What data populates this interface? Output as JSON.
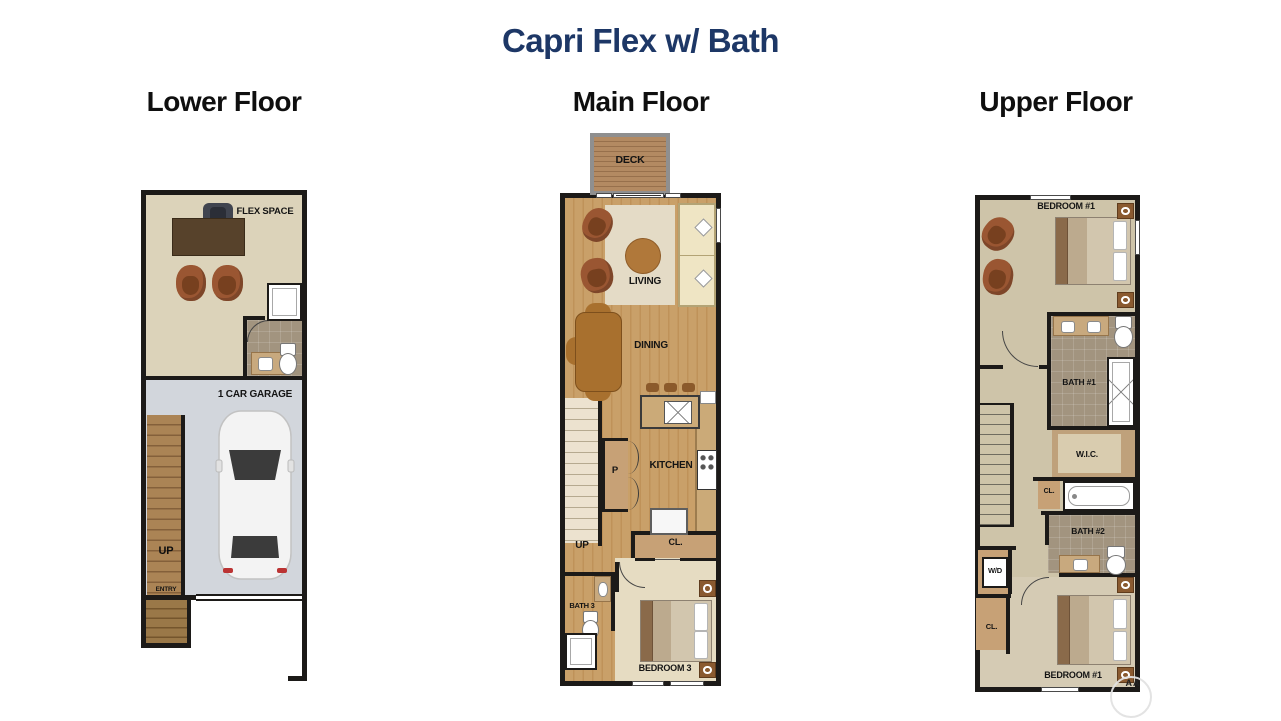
{
  "page": {
    "title": "Capri Flex w/ Bath",
    "watermark_text": "AA"
  },
  "colors": {
    "title_navy": "#1d3766",
    "heading_black": "#0f0f0f",
    "wall_black": "#1c1a18",
    "wood_floor": "#c89e63",
    "deck_wood": "#ab8560",
    "flex_beige": "#dcd3ba",
    "upper_beige": "#cec4a9",
    "bath_tile": "#a2947f",
    "garage_gray": "#d2d6dc",
    "counter_tan": "#c7a176",
    "rug_cream": "#e4dbc6",
    "furniture_brown": "#9a5632"
  },
  "floors": {
    "lower": {
      "heading": "Lower Floor",
      "labels": {
        "flex_space": "FLEX SPACE",
        "garage": "1 CAR GARAGE",
        "up": "UP",
        "entry": "ENTRY"
      }
    },
    "main": {
      "heading": "Main Floor",
      "labels": {
        "deck": "DECK",
        "living": "LIVING",
        "dining": "DINING",
        "kitchen": "KITCHEN",
        "pantry": "P",
        "up": "UP",
        "closet": "CL.",
        "bath": "BATH 3",
        "bedroom": "BEDROOM 3"
      }
    },
    "upper": {
      "heading": "Upper Floor",
      "labels": {
        "bedroom_top": "BEDROOM #1",
        "bath1": "BATH #1",
        "wic": "W.I.C.",
        "closet_mid": "CL.",
        "bath2": "BATH #2",
        "washer_dryer": "W/D",
        "closet_bottom": "CL.",
        "bedroom_bottom": "BEDROOM #1"
      }
    }
  }
}
